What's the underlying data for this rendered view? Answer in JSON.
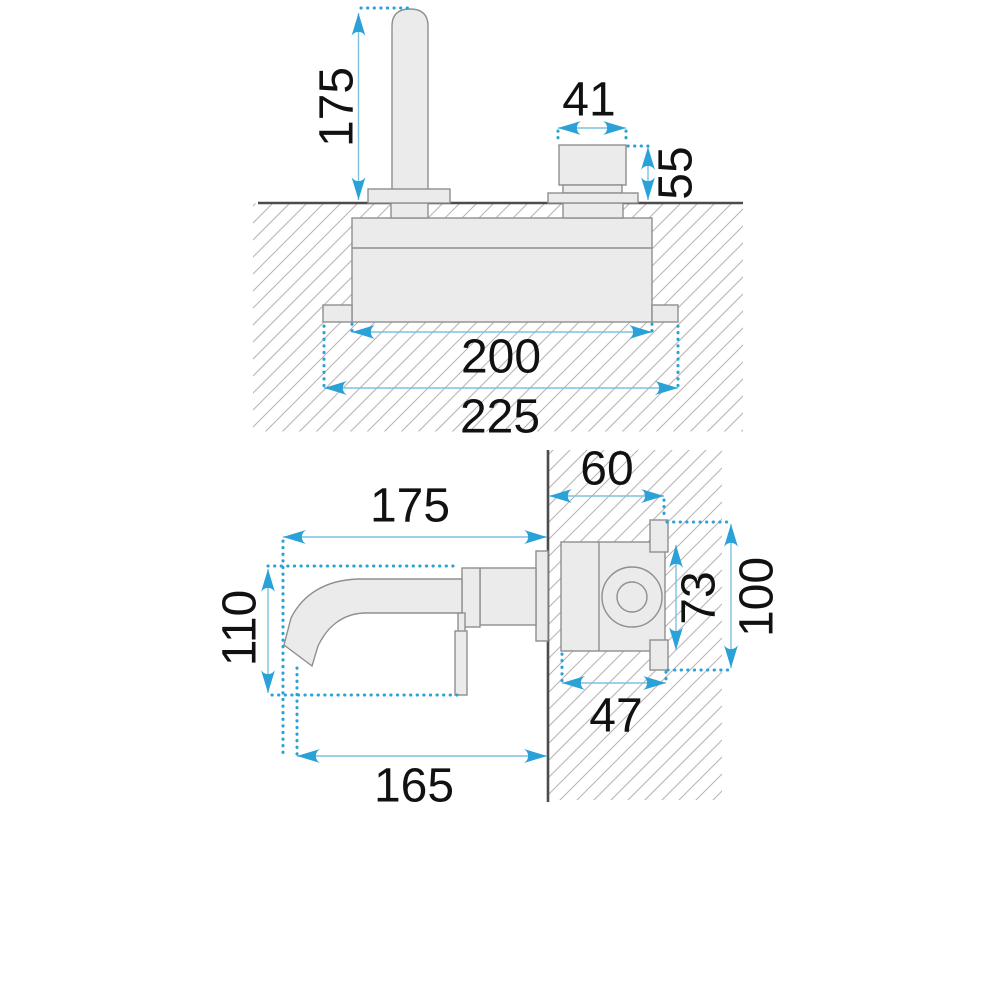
{
  "drawing": {
    "type": "technical-dimension-diagram",
    "subject": "wall-mounted basin faucet, two orthographic views with millimetre dimensions",
    "front_view": {
      "labels": {
        "spout_height": "175",
        "handle_width": "41",
        "handle_height": "55",
        "body_width": "200",
        "overall_width": "225"
      }
    },
    "side_view": {
      "labels": {
        "spout_reach": "175",
        "wall_depth": "60",
        "spout_drop": "110",
        "valve_body_height": "73",
        "overall_height": "100",
        "valve_body_depth": "47",
        "outlet_reach": "165"
      }
    },
    "colors": {
      "dimension_accent": "#2aa2d8",
      "dimension_line": "#7cc2e2",
      "part_fill": "#ebebeb",
      "part_stroke": "#8f8f8f",
      "wall_line": "#4c4c4c",
      "hatch_line": "#b9b2b2",
      "text": "#111111",
      "background": "#ffffff"
    }
  }
}
